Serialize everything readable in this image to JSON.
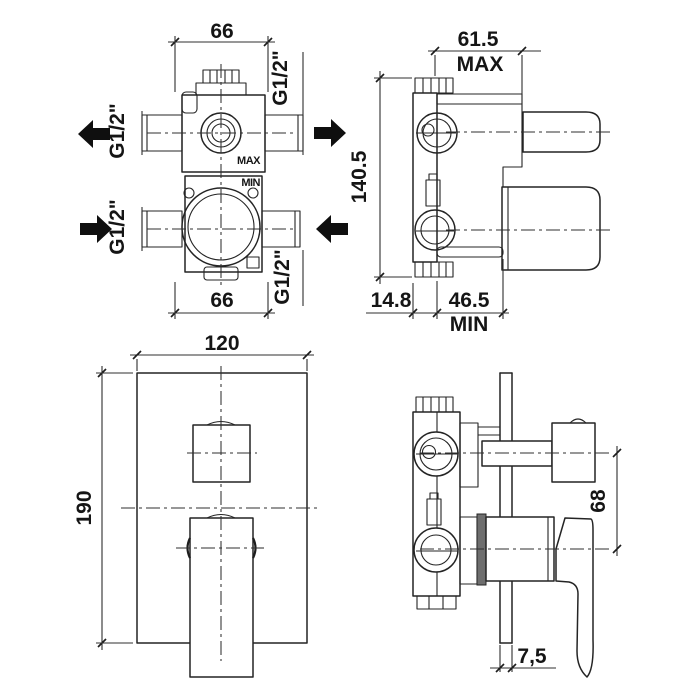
{
  "colors": {
    "background": "#ffffff",
    "ink": "#242424"
  },
  "views": {
    "valve_front": {
      "dim_width_top": "66",
      "dim_width_bottom": "66",
      "port_top_left": "G1/2\"",
      "port_top_right": "G1/2\"",
      "port_bottom_left": "G1/2\"",
      "port_bottom_right": "G1/2\"",
      "label_max": "MAX",
      "label_min": "MIN"
    },
    "valve_side": {
      "dim_depth_max": "61.5",
      "dim_depth_max_qual": "MAX",
      "dim_height": "140.5",
      "dim_back": "14.8",
      "dim_depth_min": "46.5",
      "dim_depth_min_qual": "MIN"
    },
    "trim_front": {
      "dim_width": "120",
      "dim_height": "190"
    },
    "trim_side": {
      "dim_handle_spacing": "68",
      "dim_plate_thickness": "7,5"
    }
  }
}
